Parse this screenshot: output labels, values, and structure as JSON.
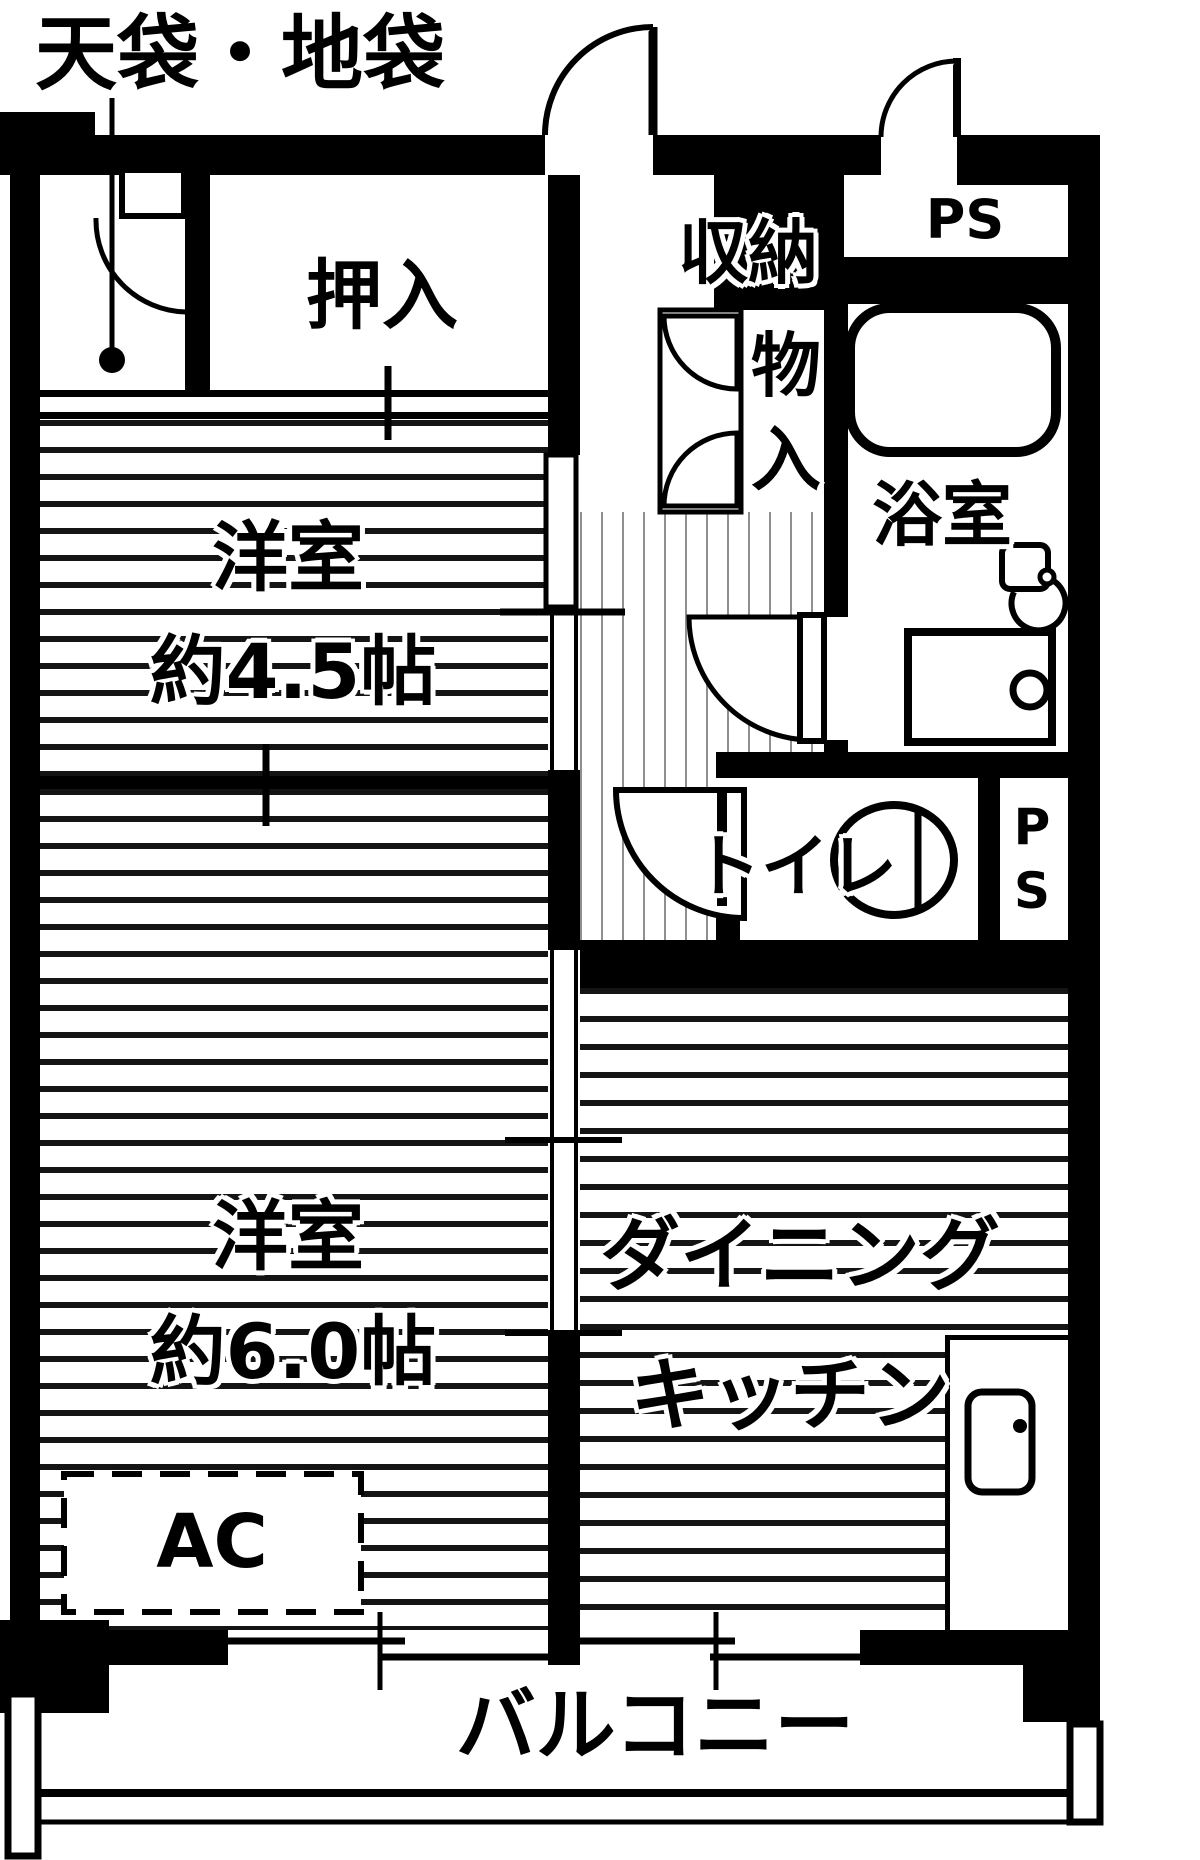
{
  "plan": {
    "annotation_label": "天袋・地袋",
    "rooms": {
      "oshiire": "押入",
      "storage_line1": "収納",
      "storage_line2": "物",
      "storage_line3": "入",
      "ps_top": "PS",
      "bath": "浴室",
      "toilet": "トイレ",
      "ps_side": "PS",
      "western1_name": "洋室",
      "western1_size": "約4.5帖",
      "western2_name": "洋室",
      "western2_size": "約6.0帖",
      "dk_line1": "ダイニング",
      "dk_line2": "キッチン",
      "ac": "AC",
      "balcony": "バルコニー"
    },
    "colors": {
      "wall": "#000000",
      "floor": "#ffffff",
      "room_stripe": "#141414",
      "hall_stripe": "#8f8f8f"
    }
  }
}
